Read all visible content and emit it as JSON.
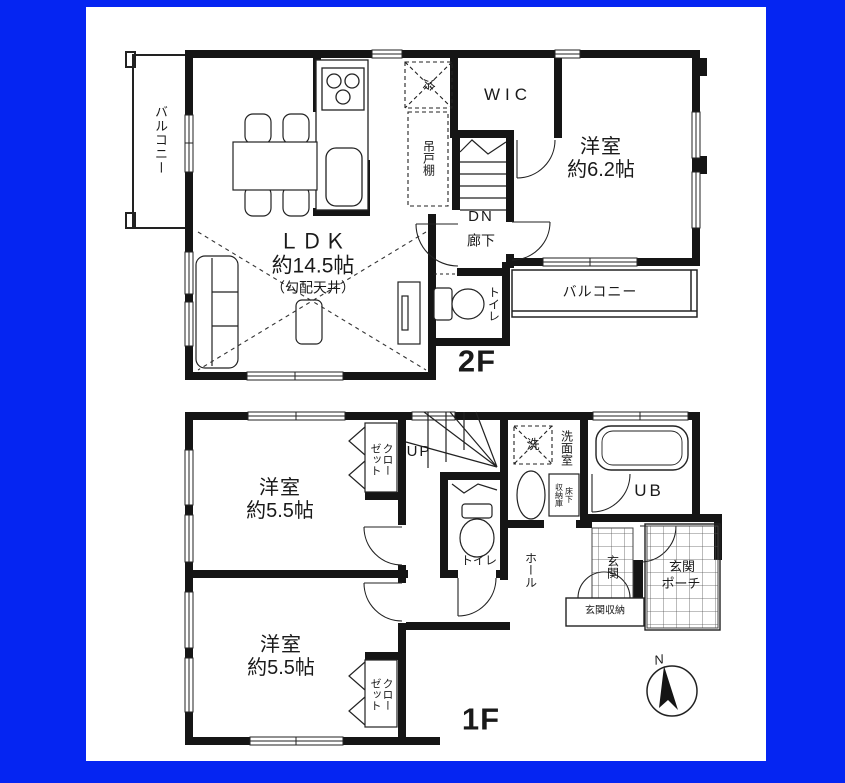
{
  "colors": {
    "frame_blue": "#0525f2",
    "wall_black": "#151515",
    "paper_white": "#ffffff"
  },
  "floor2": {
    "floor_label": "2F",
    "balcony_left": "バルコニー",
    "balcony_right": "バルコニー",
    "ldk_name": "ＬＤＫ",
    "ldk_size": "約14.5帖",
    "ldk_note": "（勾配天井）",
    "hanging_cupboard": "吊戸棚",
    "refrigerator": "冷",
    "walk_in_closet": "WIC",
    "stairs_down": "DN",
    "hallway": "廊下",
    "bedroom_name": "洋室",
    "bedroom_size": "約6.2帖",
    "toilet": "トイレ"
  },
  "floor1": {
    "floor_label": "1F",
    "bedroom1_name": "洋室",
    "bedroom1_size": "約5.5帖",
    "bedroom2_name": "洋室",
    "bedroom2_size": "約5.5帖",
    "closet1": "クローゼット",
    "closet2": "クローゼット",
    "stairs_up": "UP",
    "washer": "洗",
    "washroom": "洗面室",
    "underfloor_col1": "床下",
    "underfloor_col2": "収納庫",
    "unit_bath": "UB",
    "toilet": "トイレ",
    "hall": "ホール",
    "entrance": "玄関",
    "entrance_storage": "玄関収納",
    "porch_line1": "玄関",
    "porch_line2": "ポーチ"
  },
  "compass": {
    "north_label": "N"
  }
}
